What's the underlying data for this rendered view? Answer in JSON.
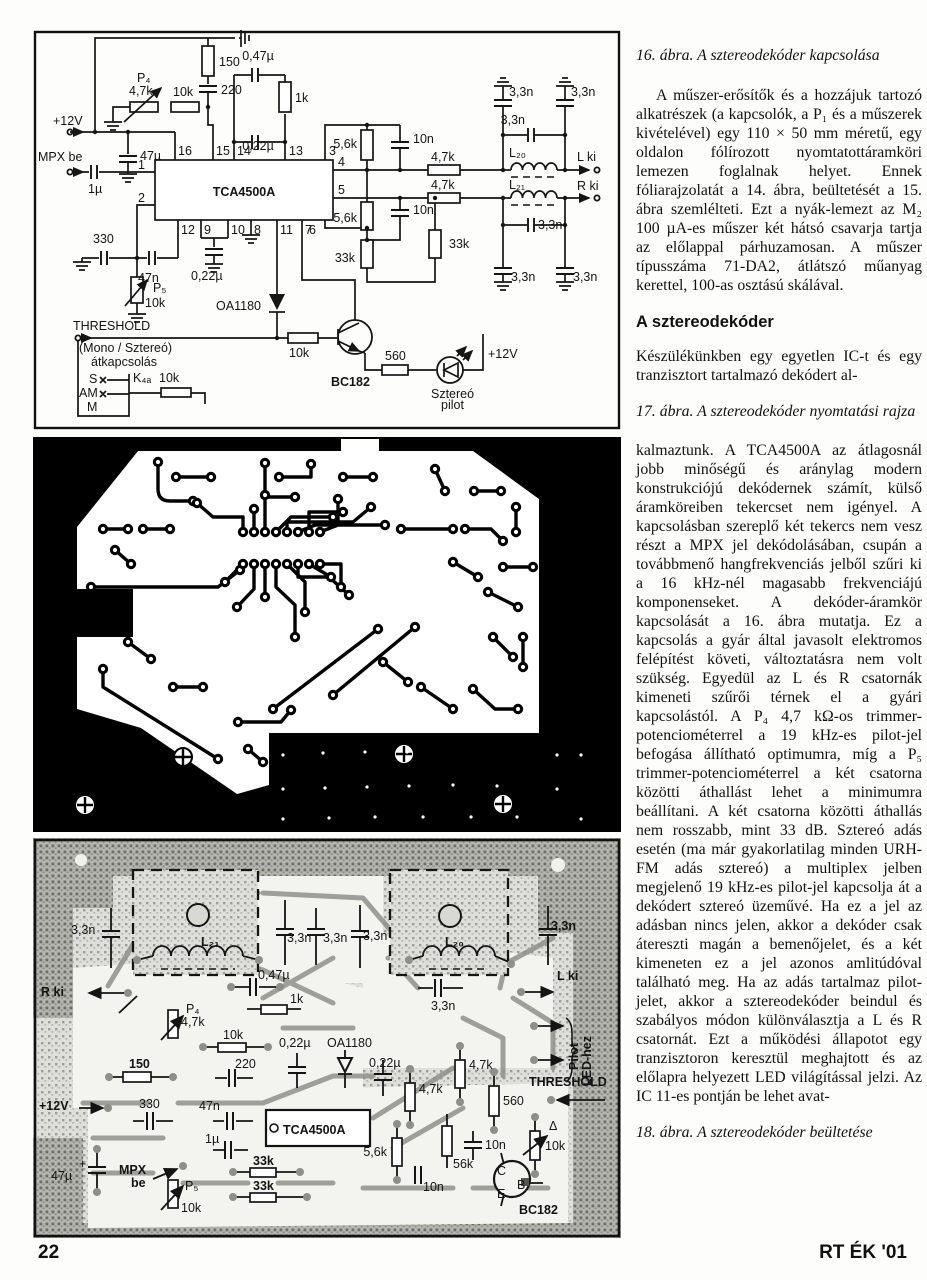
{
  "page": {
    "footer_left": "22",
    "footer_right": "RT ÉK '01"
  },
  "column": {
    "caption16": "16. ábra. A sztereodekóder kapcsolása",
    "para1": "A műszer-erősítők és a hozzájuk tartozó alkatrészek (a kapcsolók, a P₁ és a műszerek kivételével) egy 110 × 50 mm méretű, egy oldalon fólírozott nyomtatottáramköri lemezen foglalnak helyet. Ennek fóliarajzolatát a 14. ábra, beültetését a 15. ábra szemlélteti. Ezt a nyák-lemezt az M₂ 100 µA-es műszer két hátsó csavarja tartja az előlappal párhuzamosan. A műszer típusszáma 71-DA2, átlátszó műanyag kerettel, 100-as osztású skálával.",
    "heading": "A sztereodekóder",
    "para2": "Készülékünkben egy egyetlen IC-t és egy tranzisztort tartalmazó dekódert al-",
    "caption17": "17. ábra. A sztereodekóder nyomtatási rajza",
    "para3": "kalmaztunk. A TCA4500A az átlagosnál jobb minőségű és aránylag modern konstrukciójú dekódernek számít, külső áramköreiben tekercset nem igényel. A kapcsolásban szereplő két tekercs nem vesz részt a MPX jel dekódolásában, csupán a továbbmenő hangfrekvenciás jelből szűri ki a 16 kHz-nél magasabb frekvenciájú komponenseket. A dekóder-áramkör kapcsolását a 16. ábra mutatja. Ez a kapcsolás a gyár által javasolt elektromos felépítést követi, változtatásra nem volt szükség. Egyedül az L és R csatornák kimeneti szűrői térnek el a gyári kapcsolástól. A P₄ 4,7 kΩ-os trimmer-potenciométerrel a 19 kHz-es pilot-jel befogása állítható optimumra, míg a P₅ trimmer-potenciométerrel a két csatorna közötti áthallást lehet a minimumra beállítani. A két csatorna közötti áthallás nem rosszabb, mint 33 dB. Sztereó adás esetén (ma már gyakorlatilag minden URH-FM adás sztereó) a multiplex jelben megjelenő 19 kHz-es pilot-jel kapcsolja át a dekódert sztereó üzeművé. Ha ez a jel az adásban nincs jelen, akkor a dekóder csak átereszti magán a bemenőjelet, és a két kimeneten ez a jel azonos amlitúdóval található meg. Ha az adás tartalmaz pilot-jelet, akkor a sztereodekóder beindul és szabályos módon különválasztja a L és R csatornát. Ezt a működési állapotot egy tranzisztoron keresztül meghajtott és az előlapra helyezett LED világítással jelzi. Az IC 11-es pontján be lehet avat-",
    "caption18": "18. ábra. A sztereodekóder beültetése"
  },
  "fig16": {
    "labels": [
      {
        "t": "+12V",
        "x": 20,
        "y": 95
      },
      {
        "t": "MPX be",
        "x": 5,
        "y": 131
      },
      {
        "t": "1µ",
        "x": 55,
        "y": 163
      },
      {
        "t": "P₄",
        "x": 104,
        "y": 52
      },
      {
        "t": "4,7k",
        "x": 96,
        "y": 65
      },
      {
        "t": "10k",
        "x": 140,
        "y": 66
      },
      {
        "t": "150",
        "x": 186,
        "y": 36
      },
      {
        "t": "220",
        "x": 188,
        "y": 64
      },
      {
        "t": "0,47µ",
        "x": 225,
        "y": 30,
        "a": "middle"
      },
      {
        "t": "1k",
        "x": 262,
        "y": 72
      },
      {
        "t": "0,22µ",
        "x": 225,
        "y": 120,
        "a": "middle",
        "fs": 11
      },
      {
        "t": "47µ",
        "x": 107,
        "y": 130
      },
      {
        "t": "16",
        "x": 145,
        "y": 125,
        "fs": 11
      },
      {
        "t": "15",
        "x": 183,
        "y": 125,
        "fs": 11
      },
      {
        "t": "14",
        "x": 204,
        "y": 125,
        "fs": 11
      },
      {
        "t": "13",
        "x": 256,
        "y": 125,
        "fs": 11
      },
      {
        "t": "3",
        "x": 296,
        "y": 125,
        "fs": 11
      },
      {
        "t": "1",
        "x": 112,
        "y": 139,
        "a": "end",
        "fs": 11
      },
      {
        "t": "2",
        "x": 112,
        "y": 172,
        "a": "end",
        "fs": 11
      },
      {
        "t": "4",
        "x": 305,
        "y": 136,
        "fs": 11
      },
      {
        "t": "5",
        "x": 305,
        "y": 164,
        "fs": 11
      },
      {
        "t": "6",
        "x": 283,
        "y": 204,
        "a": "end",
        "fs": 11
      },
      {
        "t": "12",
        "x": 148,
        "y": 204,
        "fs": 11
      },
      {
        "t": "9",
        "x": 171,
        "y": 204,
        "fs": 11
      },
      {
        "t": "10",
        "x": 198,
        "y": 204,
        "fs": 11
      },
      {
        "t": "8",
        "x": 221,
        "y": 204,
        "fs": 11
      },
      {
        "t": "11",
        "x": 247,
        "y": 204,
        "fs": 11
      },
      {
        "t": "7",
        "x": 272,
        "y": 204,
        "fs": 11
      },
      {
        "t": "TCA4500A",
        "x": 211,
        "y": 166,
        "a": "middle",
        "fs": 16,
        "b": 1
      },
      {
        "t": "5,6k",
        "x": 324,
        "y": 118,
        "a": "end"
      },
      {
        "t": "10n",
        "x": 380,
        "y": 113
      },
      {
        "t": "4,7k",
        "x": 398,
        "y": 131
      },
      {
        "t": "L₂₀",
        "x": 476,
        "y": 127
      },
      {
        "t": "L ki",
        "x": 544,
        "y": 131
      },
      {
        "t": "4,7k",
        "x": 398,
        "y": 159
      },
      {
        "t": "L₂₁",
        "x": 476,
        "y": 159
      },
      {
        "t": "R ki",
        "x": 544,
        "y": 160
      },
      {
        "t": "3,3n",
        "x": 476,
        "y": 66
      },
      {
        "t": "3,3n",
        "x": 538,
        "y": 66
      },
      {
        "t": "3,3n",
        "x": 492,
        "y": 94,
        "a": "end"
      },
      {
        "t": "3,3n",
        "x": 505,
        "y": 199
      },
      {
        "t": "3,3n",
        "x": 478,
        "y": 251
      },
      {
        "t": "3,3n",
        "x": 540,
        "y": 251
      },
      {
        "t": "5,6k",
        "x": 324,
        "y": 192,
        "a": "end"
      },
      {
        "t": "10n",
        "x": 380,
        "y": 184
      },
      {
        "t": "33k",
        "x": 416,
        "y": 218
      },
      {
        "t": "33k",
        "x": 322,
        "y": 232,
        "a": "end"
      },
      {
        "t": "330",
        "x": 60,
        "y": 213
      },
      {
        "t": "47n",
        "x": 105,
        "y": 252
      },
      {
        "t": "0,22µ",
        "x": 158,
        "y": 250
      },
      {
        "t": "P₅",
        "x": 120,
        "y": 262
      },
      {
        "t": "10k",
        "x": 112,
        "y": 277
      },
      {
        "t": "OA1180",
        "x": 228,
        "y": 280,
        "a": "end"
      },
      {
        "t": "THRESHOLD",
        "x": 40,
        "y": 300,
        "fs": 12
      },
      {
        "t": "(Mono / Sztereó)",
        "x": 46,
        "y": 322,
        "fs": 11.5
      },
      {
        "t": "átkapcsolás",
        "x": 58,
        "y": 336,
        "fs": 11.5
      },
      {
        "t": "S",
        "x": 56,
        "y": 353
      },
      {
        "t": "AM",
        "x": 46,
        "y": 367
      },
      {
        "t": "M",
        "x": 54,
        "y": 381
      },
      {
        "t": "K₄ₐ",
        "x": 100,
        "y": 352
      },
      {
        "t": "10k",
        "x": 126,
        "y": 352
      },
      {
        "t": "10k",
        "x": 256,
        "y": 327
      },
      {
        "t": "BC182",
        "x": 298,
        "y": 356,
        "b": 1
      },
      {
        "t": "560",
        "x": 352,
        "y": 330
      },
      {
        "t": "Sztereó",
        "x": 398,
        "y": 368,
        "fs": 11.5
      },
      {
        "t": "pilot",
        "x": 408,
        "y": 379,
        "fs": 11.5
      },
      {
        "t": "+12V",
        "x": 455,
        "y": 328
      }
    ]
  },
  "fig17": {},
  "fig18": {
    "labels": [
      {
        "t": "3,3n",
        "x": 38,
        "y": 96
      },
      {
        "t": "L₂₁",
        "x": 168,
        "y": 108,
        "fs": 13,
        "b": 1
      },
      {
        "t": "R ki",
        "x": 8,
        "y": 158,
        "fs": 13,
        "b": 1
      },
      {
        "t": "0,47µ",
        "x": 225,
        "y": 141
      },
      {
        "t": "1k",
        "x": 257,
        "y": 165
      },
      {
        "t": "P₄",
        "x": 153,
        "y": 175
      },
      {
        "t": "4,7k",
        "x": 148,
        "y": 188
      },
      {
        "t": "10k",
        "x": 190,
        "y": 201
      },
      {
        "t": "3,3n",
        "x": 254,
        "y": 104
      },
      {
        "t": "3,3n",
        "x": 290,
        "y": 104
      },
      {
        "t": "3,3n",
        "x": 330,
        "y": 102
      },
      {
        "t": "L₂₀",
        "x": 412,
        "y": 108,
        "fs": 13,
        "b": 1
      },
      {
        "t": "3,3n",
        "x": 518,
        "y": 92,
        "b": 1
      },
      {
        "t": "3,3n",
        "x": 398,
        "y": 172
      },
      {
        "t": "L ki",
        "x": 524,
        "y": 142,
        "fs": 13,
        "b": 1
      },
      {
        "t": "150",
        "x": 96,
        "y": 230,
        "b": 1
      },
      {
        "t": "220",
        "x": 202,
        "y": 230
      },
      {
        "t": "0,22µ",
        "x": 246,
        "y": 209
      },
      {
        "t": "OA1180",
        "x": 294,
        "y": 209
      },
      {
        "t": "0,22µ",
        "x": 336,
        "y": 229
      },
      {
        "t": "4,7k",
        "x": 436,
        "y": 231
      },
      {
        "t": "4,7k",
        "x": 386,
        "y": 255
      },
      {
        "t": "560",
        "x": 470,
        "y": 267
      },
      {
        "t": "THRESHOLD",
        "x": 496,
        "y": 248,
        "fs": 11,
        "b": 1
      },
      {
        "t": "10n",
        "x": 452,
        "y": 311
      },
      {
        "t": "5,6k",
        "x": 354,
        "y": 318,
        "a": "end"
      },
      {
        "t": "56k",
        "x": 420,
        "y": 330
      },
      {
        "t": "10n",
        "x": 390,
        "y": 353
      },
      {
        "t": "10k",
        "x": 512,
        "y": 312
      },
      {
        "t": "BC182",
        "x": 486,
        "y": 376,
        "b": 1
      },
      {
        "t": "C",
        "x": 464,
        "y": 337,
        "fs": 10.5
      },
      {
        "t": "B",
        "x": 484,
        "y": 351,
        "fs": 10.5
      },
      {
        "t": "E",
        "x": 464,
        "y": 360,
        "fs": 10.5
      },
      {
        "t": "Δ",
        "x": 516,
        "y": 292,
        "fs": 16
      },
      {
        "t": "+12V",
        "x": 6,
        "y": 272,
        "b": 1
      },
      {
        "t": "330",
        "x": 106,
        "y": 270
      },
      {
        "t": "47n",
        "x": 166,
        "y": 272
      },
      {
        "t": "TCA4500A",
        "x": 250,
        "y": 296,
        "fs": 12.5,
        "b": 1
      },
      {
        "t": "1µ",
        "x": 172,
        "y": 305
      },
      {
        "t": "MPX",
        "x": 86,
        "y": 336,
        "b": 1
      },
      {
        "t": "be",
        "x": 98,
        "y": 349,
        "b": 1
      },
      {
        "t": "47µ",
        "x": 18,
        "y": 342
      },
      {
        "t": "+",
        "x": 46,
        "y": 330,
        "fs": 11
      },
      {
        "t": "P₅",
        "x": 152,
        "y": 352
      },
      {
        "t": "10k",
        "x": 148,
        "y": 374
      },
      {
        "t": "33k",
        "x": 220,
        "y": 327,
        "b": 1
      },
      {
        "t": "33k",
        "x": 220,
        "y": 352,
        "b": 1
      },
      {
        "t": "Pilot",
        "x": 545,
        "y": 232,
        "rot": -90,
        "fs": 11,
        "b": 1
      },
      {
        "t": "LED-hez",
        "x": 558,
        "y": 248,
        "rot": -90,
        "fs": 11,
        "b": 1
      }
    ]
  }
}
